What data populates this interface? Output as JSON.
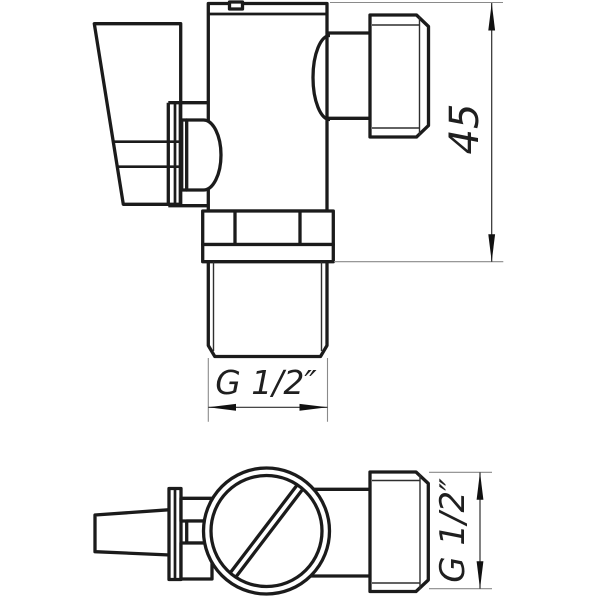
{
  "drawing": {
    "kind": "valve technical drawing, two orthographic views",
    "colors": {
      "background": "#ffffff",
      "line": "#1b1b1b"
    },
    "dimensions": {
      "body_height": {
        "label": "45"
      },
      "tail_thread": {
        "label": "G 1/2″"
      },
      "outlet_thread": {
        "label": "G 1/2″"
      }
    }
  }
}
